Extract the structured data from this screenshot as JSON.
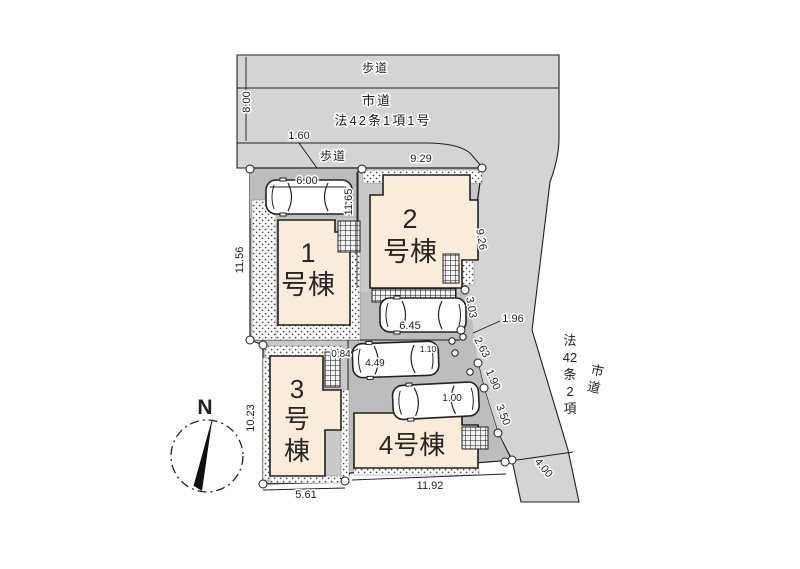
{
  "plan": {
    "title": "site-plan",
    "roads": {
      "top": {
        "sidewalk_label": "歩道",
        "name": "市道",
        "law": "法42条1項1号",
        "sidewalk_label2": "歩道",
        "width_dim": "8.00"
      },
      "right": {
        "name_lines": [
          "市",
          "道"
        ],
        "law_lines": [
          "法",
          "42",
          "条",
          "2",
          "項"
        ],
        "width_dim": "4.00"
      }
    },
    "buildings": [
      {
        "id": "1",
        "lines": [
          "1",
          "号棟"
        ]
      },
      {
        "id": "2",
        "lines": [
          "2",
          "号棟"
        ]
      },
      {
        "id": "3",
        "lines": [
          "3",
          "号",
          "棟"
        ]
      },
      {
        "id": "4",
        "lines": [
          "4号棟"
        ]
      }
    ],
    "dims": {
      "road_top_width": "8.00",
      "sidewalk_offset": "1.60",
      "car_a_length": "6.00",
      "frontage_top": "9.29",
      "depth_center": "11.65",
      "depth_left": "11.56",
      "depth_left_lower": "10.23",
      "plot3_width": "5.61",
      "plot4_width": "11.92",
      "car_b_length": "6.45",
      "mid_a": "0.84",
      "mid_b": "4.49",
      "mid_c": "1.10",
      "car_d": "1.00",
      "diag_a": "9.26",
      "diag_b": "3.03",
      "diag_leader": "1.96",
      "diag_c": "2.63",
      "diag_d": "1.90",
      "diag_e": "3.50",
      "road_right_width": "4.00"
    },
    "compass": {
      "label": "N"
    },
    "colors": {
      "road": "#d4d4d4",
      "parcel": "#c9c9c9",
      "driveway": "#bdbdbd",
      "building": "#f9ecd9",
      "line": "#1f1f1f",
      "background": "#ffffff"
    }
  }
}
